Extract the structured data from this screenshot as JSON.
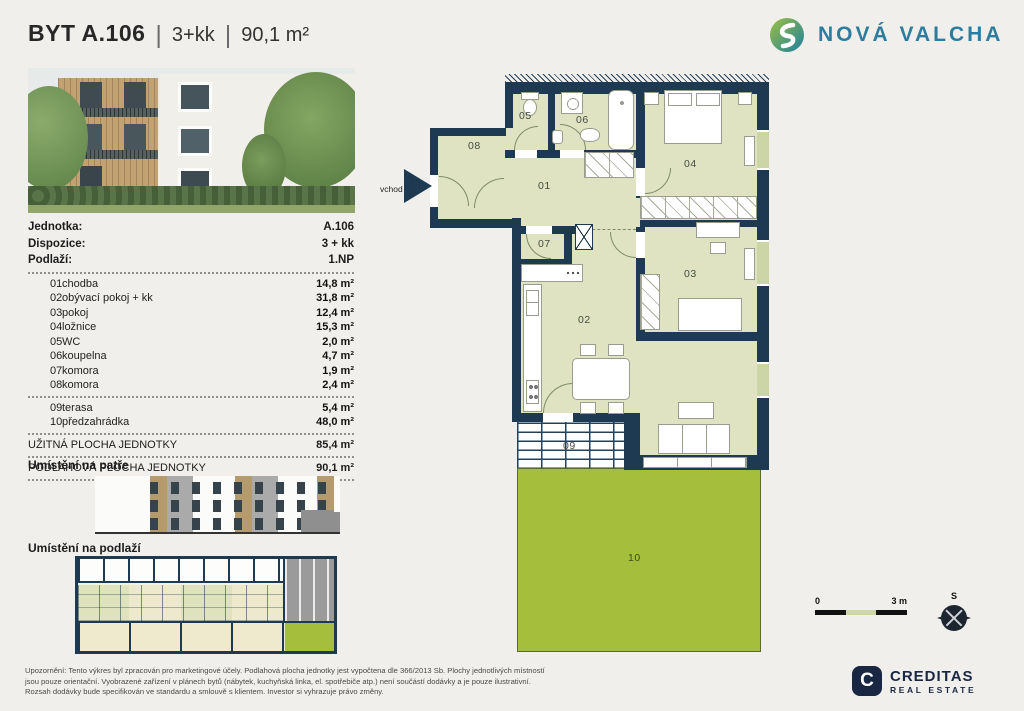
{
  "header": {
    "title": "BYT A.106",
    "sep": "|",
    "layout": "3+kk",
    "area": "90,1 m²"
  },
  "brand": {
    "name": "NOVÁ VALCHA"
  },
  "info": {
    "rows": [
      {
        "label": "Jednotka:",
        "value": "A.106"
      },
      {
        "label": "Dispozice:",
        "value": "3 + kk"
      },
      {
        "label": "Podlaží:",
        "value": "1.NP"
      }
    ]
  },
  "rooms": [
    {
      "num": "01",
      "name": "chodba",
      "area": "14,8 m²"
    },
    {
      "num": "02",
      "name": "obývací pokoj + kk",
      "area": "31,8 m²"
    },
    {
      "num": "03",
      "name": "pokoj",
      "area": "12,4 m²"
    },
    {
      "num": "04",
      "name": "ložnice",
      "area": "15,3 m²"
    },
    {
      "num": "05",
      "name": "WC",
      "area": "2,0 m²"
    },
    {
      "num": "06",
      "name": "koupelna",
      "area": "4,7 m²"
    },
    {
      "num": "07",
      "name": "komora",
      "area": "1,9 m²"
    },
    {
      "num": "08",
      "name": "komora",
      "area": "2,4 m²"
    },
    {
      "num": "09",
      "name": "terasa",
      "area": "5,4 m²"
    },
    {
      "num": "10",
      "name": "předzahrádka",
      "area": "48,0 m²"
    }
  ],
  "totals": [
    {
      "label": "UŽITNÁ PLOCHA JEDNOTKY",
      "area": "85,4 m²"
    },
    {
      "label": "PODLAHOVÁ PLOCHA JEDNOTKY",
      "area": "90,1 m²"
    }
  ],
  "sections": {
    "floor_location": "Umístění na patře",
    "level_location": "Umístění na podlaží"
  },
  "plan": {
    "entrance": "vchod",
    "labels": {
      "r01": "01",
      "r02": "02",
      "r03": "03",
      "r04": "04",
      "r05": "05",
      "r06": "06",
      "r07": "07",
      "r08": "08",
      "r09": "09",
      "r10": "10"
    },
    "scale_zero": "0",
    "scale_max": "3 m",
    "compass": "S"
  },
  "footer": {
    "lines": [
      "Upozornění: Tento výkres byl zpracován pro marketingové účely. Podlahová plocha jednotky jest vypočtena dle 366/2013 Sb. Plochy jednotlivých místností",
      "jsou pouze orientační. Vyobrazené zařízení v plánech bytů (nábytek, kuchyňská linka, el. spotřebiče atp.) není součástí dodávky a je pouze ilustrativní.",
      "Rozsah dodávky bude specifikován ve standardu a smlouvě s klientem. Investor si vyhrazuje právo změny."
    ],
    "logo_letter": "C",
    "logo_text": "CREDITAS",
    "logo_sub": "REAL ESTATE"
  },
  "colors": {
    "wall_navy": "#1d3a52",
    "room_sage": "#dfe3c1",
    "garden_green": "#a5bf3c",
    "brand_teal": "#2e7d9f",
    "background": "#f0efeb"
  }
}
